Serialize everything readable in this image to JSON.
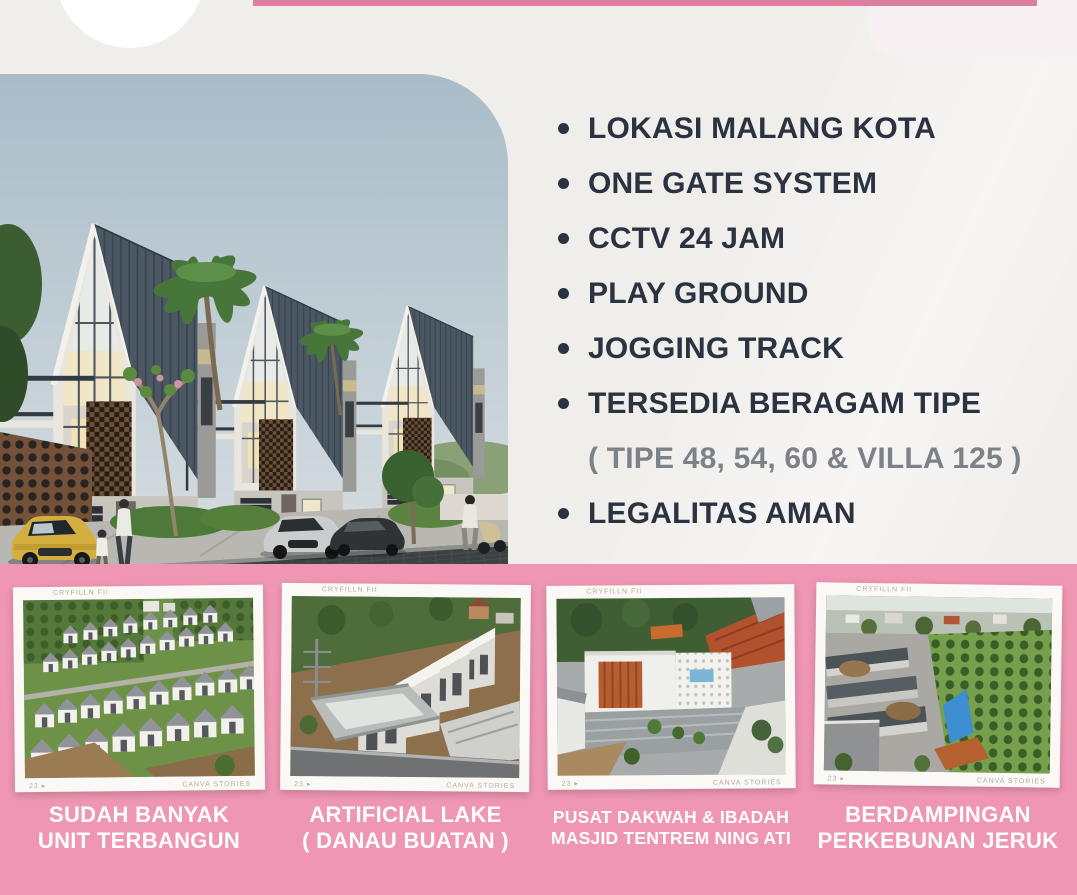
{
  "palette": {
    "page_background": "#f0eeeb",
    "accent_pink": "#dc7f9e",
    "panel_pink": "#ee96b4",
    "text_dark": "#2b3240",
    "text_gray": "#7c8287",
    "caption_white": "#ffffff"
  },
  "features": {
    "items": [
      {
        "label": "LOKASI MALANG KOTA",
        "sub": false
      },
      {
        "label": "ONE GATE SYSTEM",
        "sub": false
      },
      {
        "label": "CCTV 24 JAM",
        "sub": false
      },
      {
        "label": "PLAY GROUND",
        "sub": false
      },
      {
        "label": "JOGGING TRACK",
        "sub": false
      },
      {
        "label": "TERSEDIA BERAGAM TIPE",
        "sub": false
      },
      {
        "label": "( TIPE 48, 54, 60 & VILLA 125 )",
        "sub": true
      },
      {
        "label": "LEGALITAS AMAN",
        "sub": false
      }
    ]
  },
  "gallery": {
    "watermark_top": "CRYFILLN FII",
    "watermark_page": "23 ▸",
    "watermark_brand": "CANVA STORIES",
    "photos": [
      {
        "caption_line1": "SUDAH BANYAK",
        "caption_line2": "UNIT TERBANGUN"
      },
      {
        "caption_line1": "ARTIFICIAL LAKE",
        "caption_line2": "( DANAU BUATAN )"
      },
      {
        "caption_line1": "PUSAT DAKWAH & IBADAH",
        "caption_line2": "MASJID TENTREM NING ATI"
      },
      {
        "caption_line1": "BERDAMPINGAN",
        "caption_line2": "PERKEBUNAN JERUK"
      }
    ]
  }
}
